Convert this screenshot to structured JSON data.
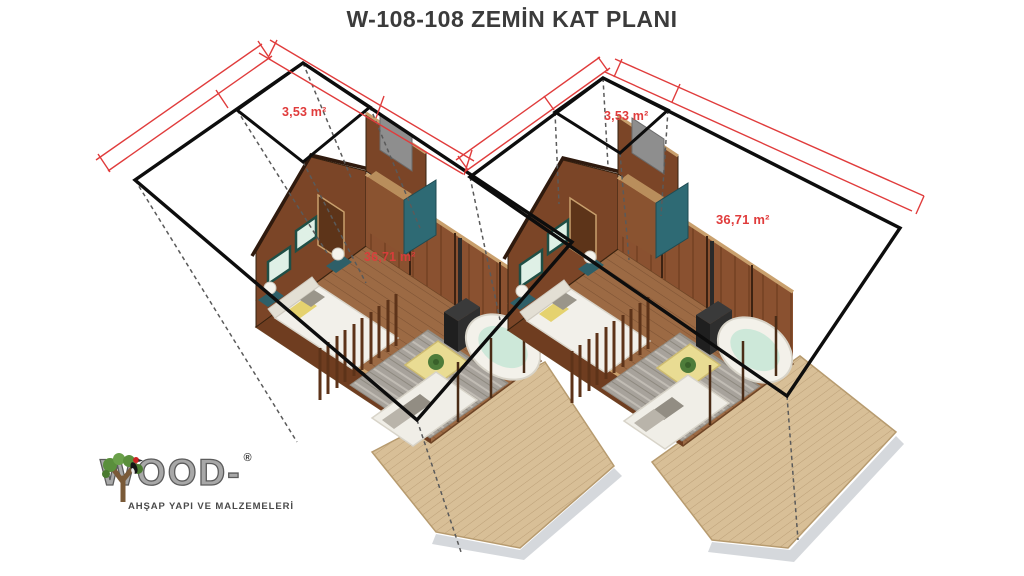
{
  "title": "W-108-108 ZEMİN KAT PLANI",
  "labels": {
    "left_porch_area": "3,53 m²",
    "right_porch_area": "3,53 m²",
    "left_floor_area": "36,71 m²",
    "right_floor_area": "36,71 m²"
  },
  "logo": {
    "brand": "WOOD-",
    "registered": "®",
    "tagline": "AHŞAP YAPI VE MALZEMELERİ"
  },
  "colors": {
    "dimension_red": "#e03c3c",
    "outline_black": "#0d0d0d",
    "projection_gray": "#5a5a5a",
    "wall_wood_dark": "#6f3d20",
    "wall_wood": "#7b4527",
    "wall_interior": "#8a5130",
    "wall_top_cut": "#c9a06d",
    "floor_wood": "#9c6a44",
    "deck_wood": "#d8bf97",
    "accent_teal": "#2e6a74",
    "rug_gray": "#a7a29b",
    "furniture_white": "#f2f0ea",
    "pillow_yellow": "#e5d26f",
    "plant_green": "#4e7c3a",
    "stove_black": "#262626"
  }
}
